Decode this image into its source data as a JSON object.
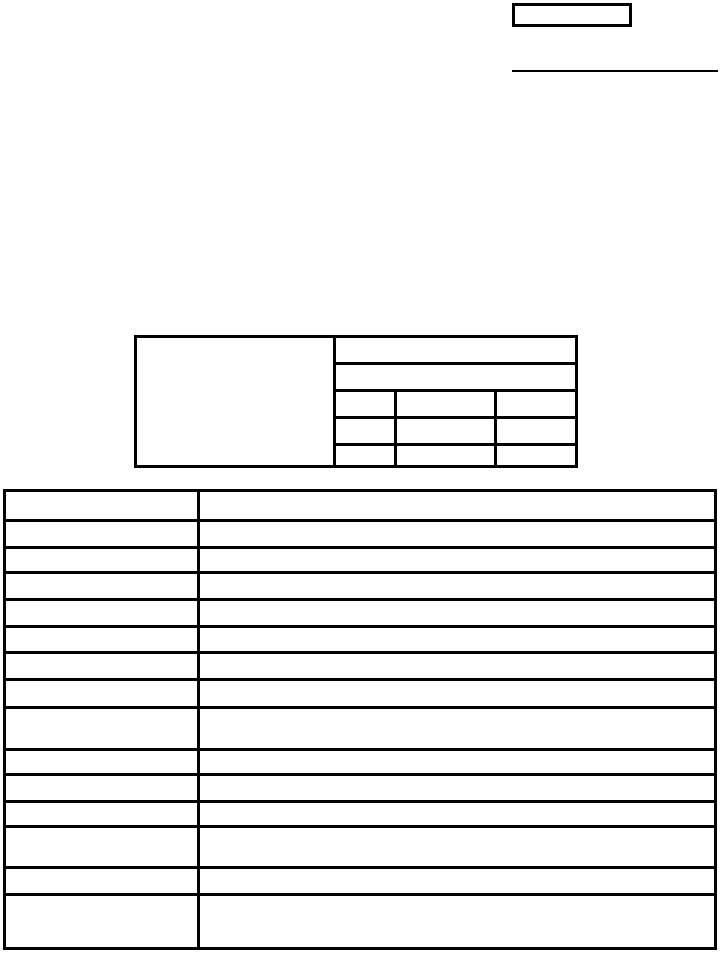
{
  "page": {
    "background_color": "#ffffff",
    "line_color": "#000000"
  },
  "header": {
    "corner_box_value": "",
    "underline_value": ""
  },
  "info_table": {
    "left_panel_value": "",
    "top_row_value": "",
    "second_row_value": "",
    "grid_rows": [
      {
        "col1": "",
        "col2": "",
        "col3": ""
      },
      {
        "col1": "",
        "col2": "",
        "col3": ""
      },
      {
        "col1": "",
        "col2": "",
        "col3": ""
      }
    ]
  },
  "main_table": {
    "rows": [
      {
        "label": "",
        "value": ""
      },
      {
        "label": "",
        "value": ""
      },
      {
        "label": "",
        "value": ""
      },
      {
        "label": "",
        "value": ""
      },
      {
        "label": "",
        "value": ""
      },
      {
        "label": "",
        "value": ""
      },
      {
        "label": "",
        "value": ""
      },
      {
        "label": "",
        "value": ""
      },
      {
        "label": "",
        "value": ""
      },
      {
        "label": "",
        "value": ""
      },
      {
        "label": "",
        "value": ""
      },
      {
        "label": "",
        "value": ""
      },
      {
        "label": "",
        "value": ""
      },
      {
        "label": "",
        "value": ""
      },
      {
        "label": "",
        "value": ""
      }
    ]
  }
}
